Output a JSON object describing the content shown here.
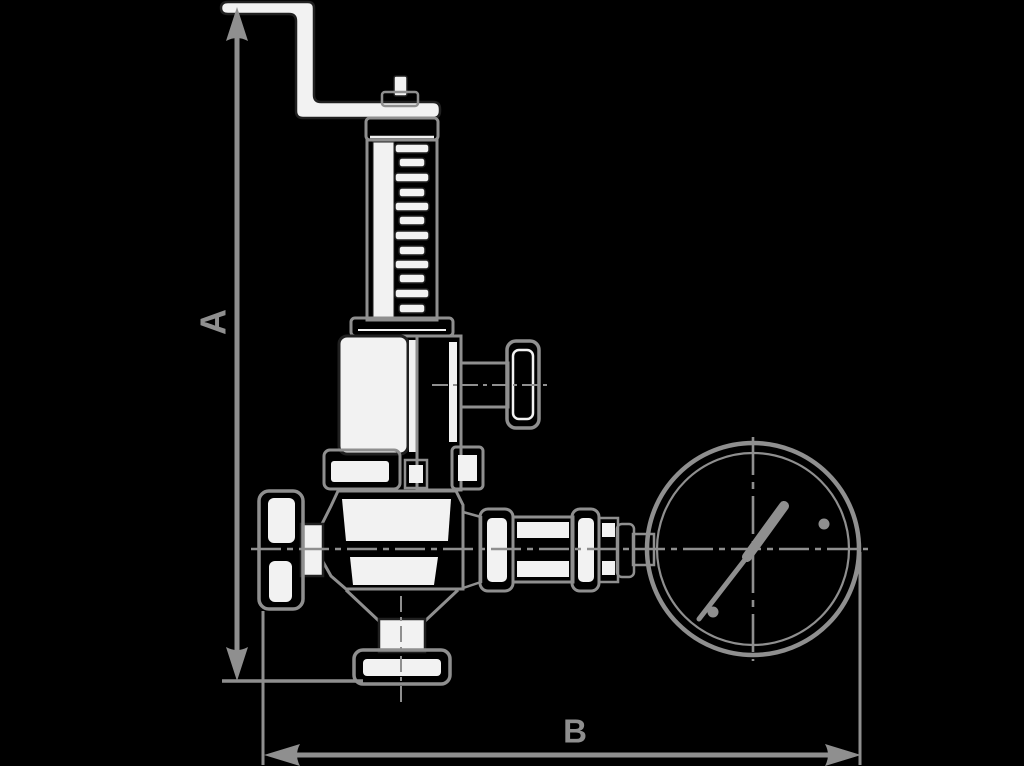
{
  "diagram": {
    "labels": {
      "dimension_a": "A",
      "dimension_b": "B"
    },
    "colors": {
      "background": "#000000",
      "line": "#8f8f8f",
      "fill": "#f2f2f2",
      "ink": "#202020"
    }
  }
}
